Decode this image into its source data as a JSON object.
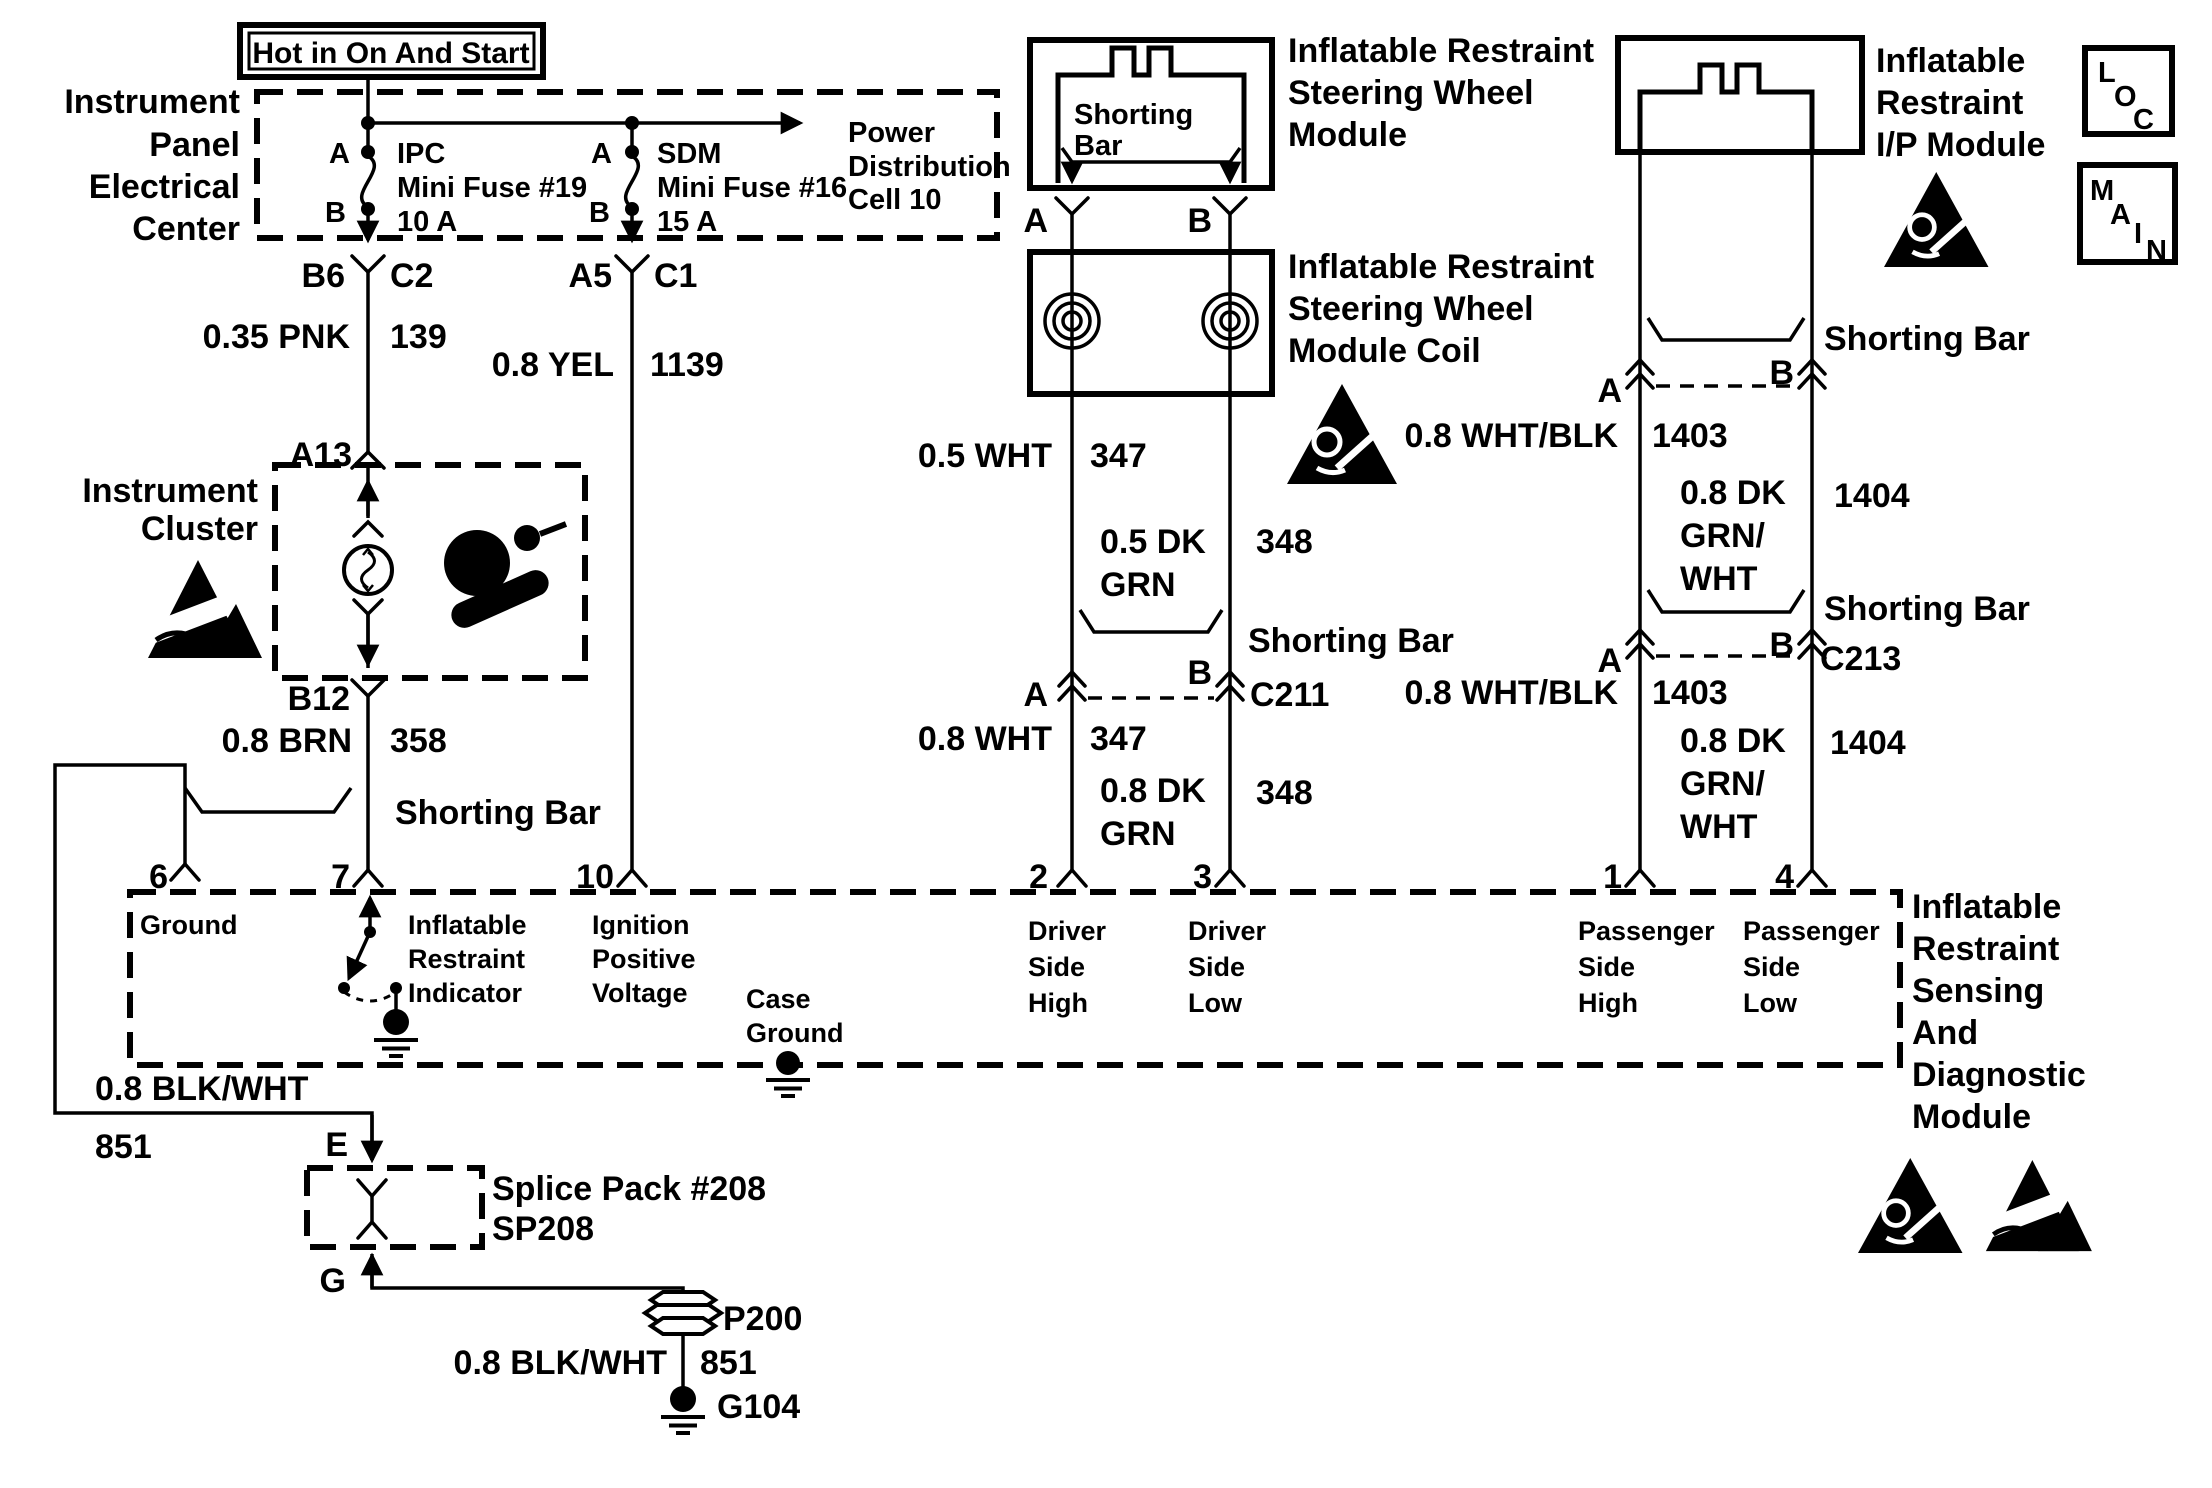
{
  "colors": {
    "ink": "#000000",
    "paper": "#ffffff"
  },
  "labels": {
    "shorting_bar": "Shorting Bar"
  },
  "hot_box": {
    "label": "Hot in On And Start"
  },
  "ipec": {
    "name": [
      "Instrument",
      "Panel",
      "Electrical",
      "Center"
    ],
    "power": [
      "Power",
      "Distribution",
      "Cell 10"
    ],
    "fuse_ipc": {
      "pin_a": "A",
      "pin_b": "B",
      "name": "IPC",
      "desc": "Mini Fuse #19",
      "rating": "10 A"
    },
    "fuse_sdm": {
      "pin_a": "A",
      "pin_b": "B",
      "name": "SDM",
      "desc": "Mini Fuse #16",
      "rating": "15 A"
    }
  },
  "connectors": {
    "b6": "B6",
    "c2": "C2",
    "a5": "A5",
    "c1": "C1",
    "a13": "A13",
    "b12": "B12",
    "c211": {
      "a": "A",
      "b": "B",
      "name": "C211"
    },
    "ip_inline": {
      "a": "A",
      "b": "B"
    },
    "c213": {
      "a": "A",
      "b": "B",
      "name": "C213"
    },
    "splice_in": "E",
    "splice_out": "G"
  },
  "wires": {
    "pnk": {
      "gauge": "0.35 PNK",
      "circuit": "139"
    },
    "yel": {
      "gauge": "0.8 YEL",
      "circuit": "1139"
    },
    "brn": {
      "gauge": "0.8 BRN",
      "circuit": "358"
    },
    "wht_upper": {
      "gauge": "0.5 WHT",
      "circuit": "347"
    },
    "dkgrn_upper": {
      "l1": "0.5 DK",
      "l2": "GRN",
      "circuit": "348"
    },
    "wht_lower": {
      "gauge": "0.8 WHT",
      "circuit": "347"
    },
    "dkgrn_lower": {
      "l1": "0.8 DK",
      "l2": "GRN",
      "circuit": "348"
    },
    "whtblk_upper": {
      "gauge": "0.8 WHT/BLK",
      "circuit": "1403"
    },
    "dkgrnwht_upper": {
      "l1": "0.8 DK",
      "l2": "GRN/",
      "l3": "WHT",
      "circuit": "1404"
    },
    "whtblk_lower": {
      "gauge": "0.8 WHT/BLK",
      "circuit": "1403"
    },
    "dkgrnwht_lower": {
      "l1": "0.8 DK",
      "l2": "GRN/",
      "l3": "WHT",
      "circuit": "1404"
    },
    "blkwht_left": {
      "gauge": "0.8 BLK/WHT",
      "circuit": "851"
    },
    "blkwht_ground": {
      "gauge": "0.8 BLK/WHT",
      "circuit": "851"
    }
  },
  "cluster": {
    "name": [
      "Instrument",
      "Cluster"
    ]
  },
  "swm": {
    "inner": [
      "Shorting",
      "Bar"
    ],
    "name": [
      "Inflatable Restraint",
      "Steering Wheel",
      "Module"
    ],
    "pin_a": "A",
    "pin_b": "B"
  },
  "coil": {
    "name": [
      "Inflatable Restraint",
      "Steering Wheel",
      "Module Coil"
    ]
  },
  "ipm": {
    "name": [
      "Inflatable",
      "Restraint",
      "I/P Module"
    ]
  },
  "sdm": {
    "name": [
      "Inflatable",
      "Restraint",
      "Sensing",
      "And",
      "Diagnostic",
      "Module"
    ],
    "pins": {
      "p6": "6",
      "p7": "7",
      "p10": "10",
      "p2": "2",
      "p3": "3",
      "p1": "1",
      "p4": "4"
    },
    "fn_ground": "Ground",
    "fn_indicator": [
      "Inflatable",
      "Restraint",
      "Indicator"
    ],
    "fn_ignition": [
      "Ignition",
      "Positive",
      "Voltage"
    ],
    "fn_case_ground": [
      "Case",
      "Ground"
    ],
    "fn_driver_high": [
      "Driver",
      "Side",
      "High"
    ],
    "fn_driver_low": [
      "Driver",
      "Side",
      "Low"
    ],
    "fn_pass_high": [
      "Passenger",
      "Side",
      "High"
    ],
    "fn_pass_low": [
      "Passenger",
      "Side",
      "Low"
    ]
  },
  "splice": {
    "name": "Splice Pack #208",
    "id": "SP208"
  },
  "grounds": {
    "p200": "P200",
    "g104": "G104"
  },
  "ref_boxes": {
    "loc": [
      "L",
      "O",
      "C"
    ],
    "main": [
      "M",
      "A",
      "I",
      "N"
    ]
  }
}
